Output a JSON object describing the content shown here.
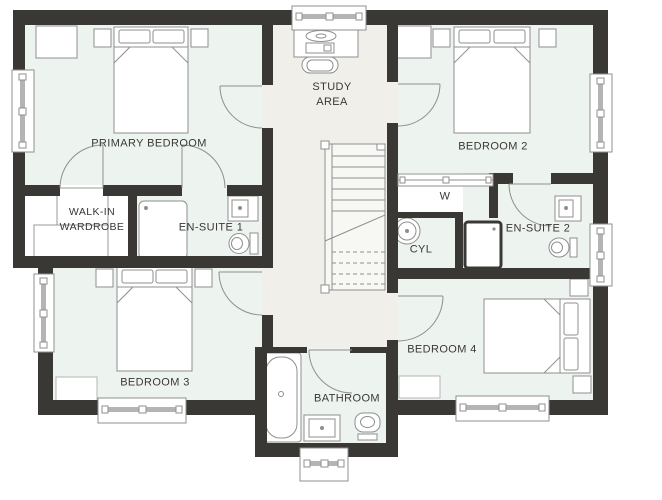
{
  "colors": {
    "wall": "#3a3835",
    "room_fill": "#edf3ef",
    "hall_fill": "#f0efea",
    "fixture_outline": "#8f8f8f",
    "window_glass": "#b4b4b4",
    "text": "#3a3835"
  },
  "rooms": {
    "primary_bedroom": {
      "label": "PRIMARY BEDROOM"
    },
    "walk_in_wardrobe": {
      "line1": "WALK-IN",
      "line2": "WARDROBE"
    },
    "en_suite_1": {
      "label": "EN-SUITE 1"
    },
    "study_area": {
      "line1": "STUDY",
      "line2": "AREA"
    },
    "bedroom_2": {
      "label": "BEDROOM 2"
    },
    "wardrobe": {
      "label": "W"
    },
    "cylinder_cupboard": {
      "label": "CYL"
    },
    "en_suite_2": {
      "label": "EN-SUITE 2"
    },
    "bedroom_3": {
      "label": "BEDROOM 3"
    },
    "bathroom": {
      "label": "BATHROOM"
    },
    "bedroom_4": {
      "label": "BEDROOM 4"
    }
  },
  "fixtures": {
    "beds": 4,
    "windows": 8,
    "doors": 8,
    "toilets": 3,
    "sinks": 3,
    "showers": 2,
    "bathtubs": 1,
    "cylinder_tanks": 1,
    "desks": 1,
    "staircases": 1
  }
}
